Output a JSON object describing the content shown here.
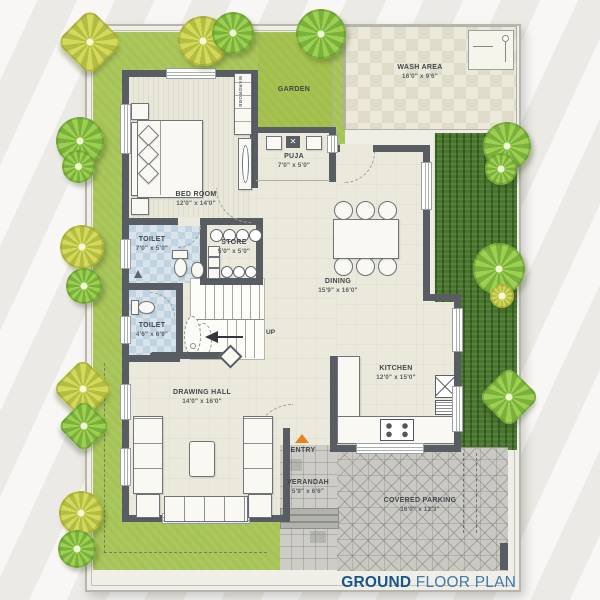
{
  "title": {
    "bold": "GROUND",
    "rest": " FLOOR PLAN"
  },
  "rooms": {
    "wash_area": {
      "name": "WASH AREA",
      "dims": "16'0\" x 9'6\""
    },
    "garden": {
      "name": "GARDEN"
    },
    "puja": {
      "name": "PUJA",
      "dims": "7'0\" x 5'0\""
    },
    "bed_room": {
      "name": "BED ROOM",
      "dims": "12'0\" x 14'0\"",
      "wardrobe": "WARDROBE"
    },
    "toilet_1": {
      "name": "TOILET",
      "dims": "7'0\" x 5'0\""
    },
    "store": {
      "name": "STORE",
      "dims": "5'0\" x 5'0\""
    },
    "dining": {
      "name": "DINING",
      "dims": "15'9\" x 16'0\""
    },
    "toilet_2": {
      "name": "TOILET",
      "dims": "4'6\" x 6'9\""
    },
    "kitchen": {
      "name": "KITCHEN",
      "dims": "12'0\" x 15'0\""
    },
    "drawing_hall": {
      "name": "DRAWING HALL",
      "dims": "14'0\" x 16'0\""
    },
    "verandah": {
      "name": "VERANDAH",
      "dims": "5'9\" x 6'6\""
    },
    "covered_parking": {
      "name": "COVERED PARKING",
      "dims": "16'0\" x 12'3\""
    }
  },
  "annotations": {
    "entry": "ENTRY",
    "up": "UP"
  },
  "colors": {
    "lawn_green": "#a6c355",
    "hedge_green": "#47762c",
    "wall_gray": "#585d64",
    "toilet_tile_blue": "#bfd3e0",
    "entry_arrow_orange": "#e8821e",
    "title_blue_bold": "#17548e",
    "title_blue_light": "#4179ad"
  },
  "icons": {
    "tree": "tree-icon",
    "wash_basin": "wash-basin-icon",
    "wc": "toilet-wc-icon",
    "washbasin": "washbasin-icon",
    "bathtub": "bathtub-icon",
    "bed": "bed-icon",
    "wardrobe": "wardrobe-icon",
    "dresser": "dresser-icon",
    "dining_table": "dining-table-icon",
    "chair": "chair-icon",
    "sofa": "sofa-icon",
    "coffee_table": "coffee-table-icon",
    "stove": "stove-icon",
    "kitchen_sink": "kitchen-sink-icon",
    "stairs_arrow": "stairs-up-arrow-icon",
    "entry_arrow": "entry-arrow-icon",
    "puja_shelf": "puja-shelf-icon",
    "store_rack": "store-rack-icon"
  }
}
